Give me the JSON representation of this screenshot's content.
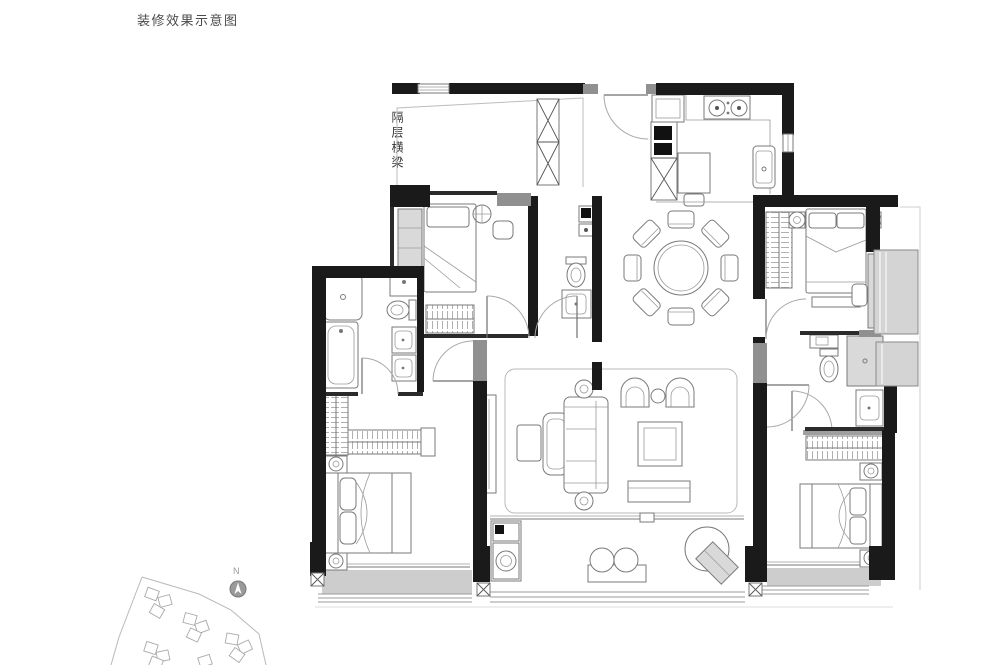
{
  "page": {
    "title": "装修效果示意图"
  },
  "plan": {
    "beam_label": "隔层横梁",
    "colors": {
      "wall": "#1a1a1a",
      "secondary_wall": "#909090",
      "furniture_line": "#7a7a7a",
      "cabinet_fill": "#d9d9d9",
      "bay_window_fill": "#d4d4d4",
      "balcony_floor_fill": "#cdcdcd",
      "door_arc": "#a8a8a8"
    }
  },
  "site": {
    "compass_label": "N"
  }
}
